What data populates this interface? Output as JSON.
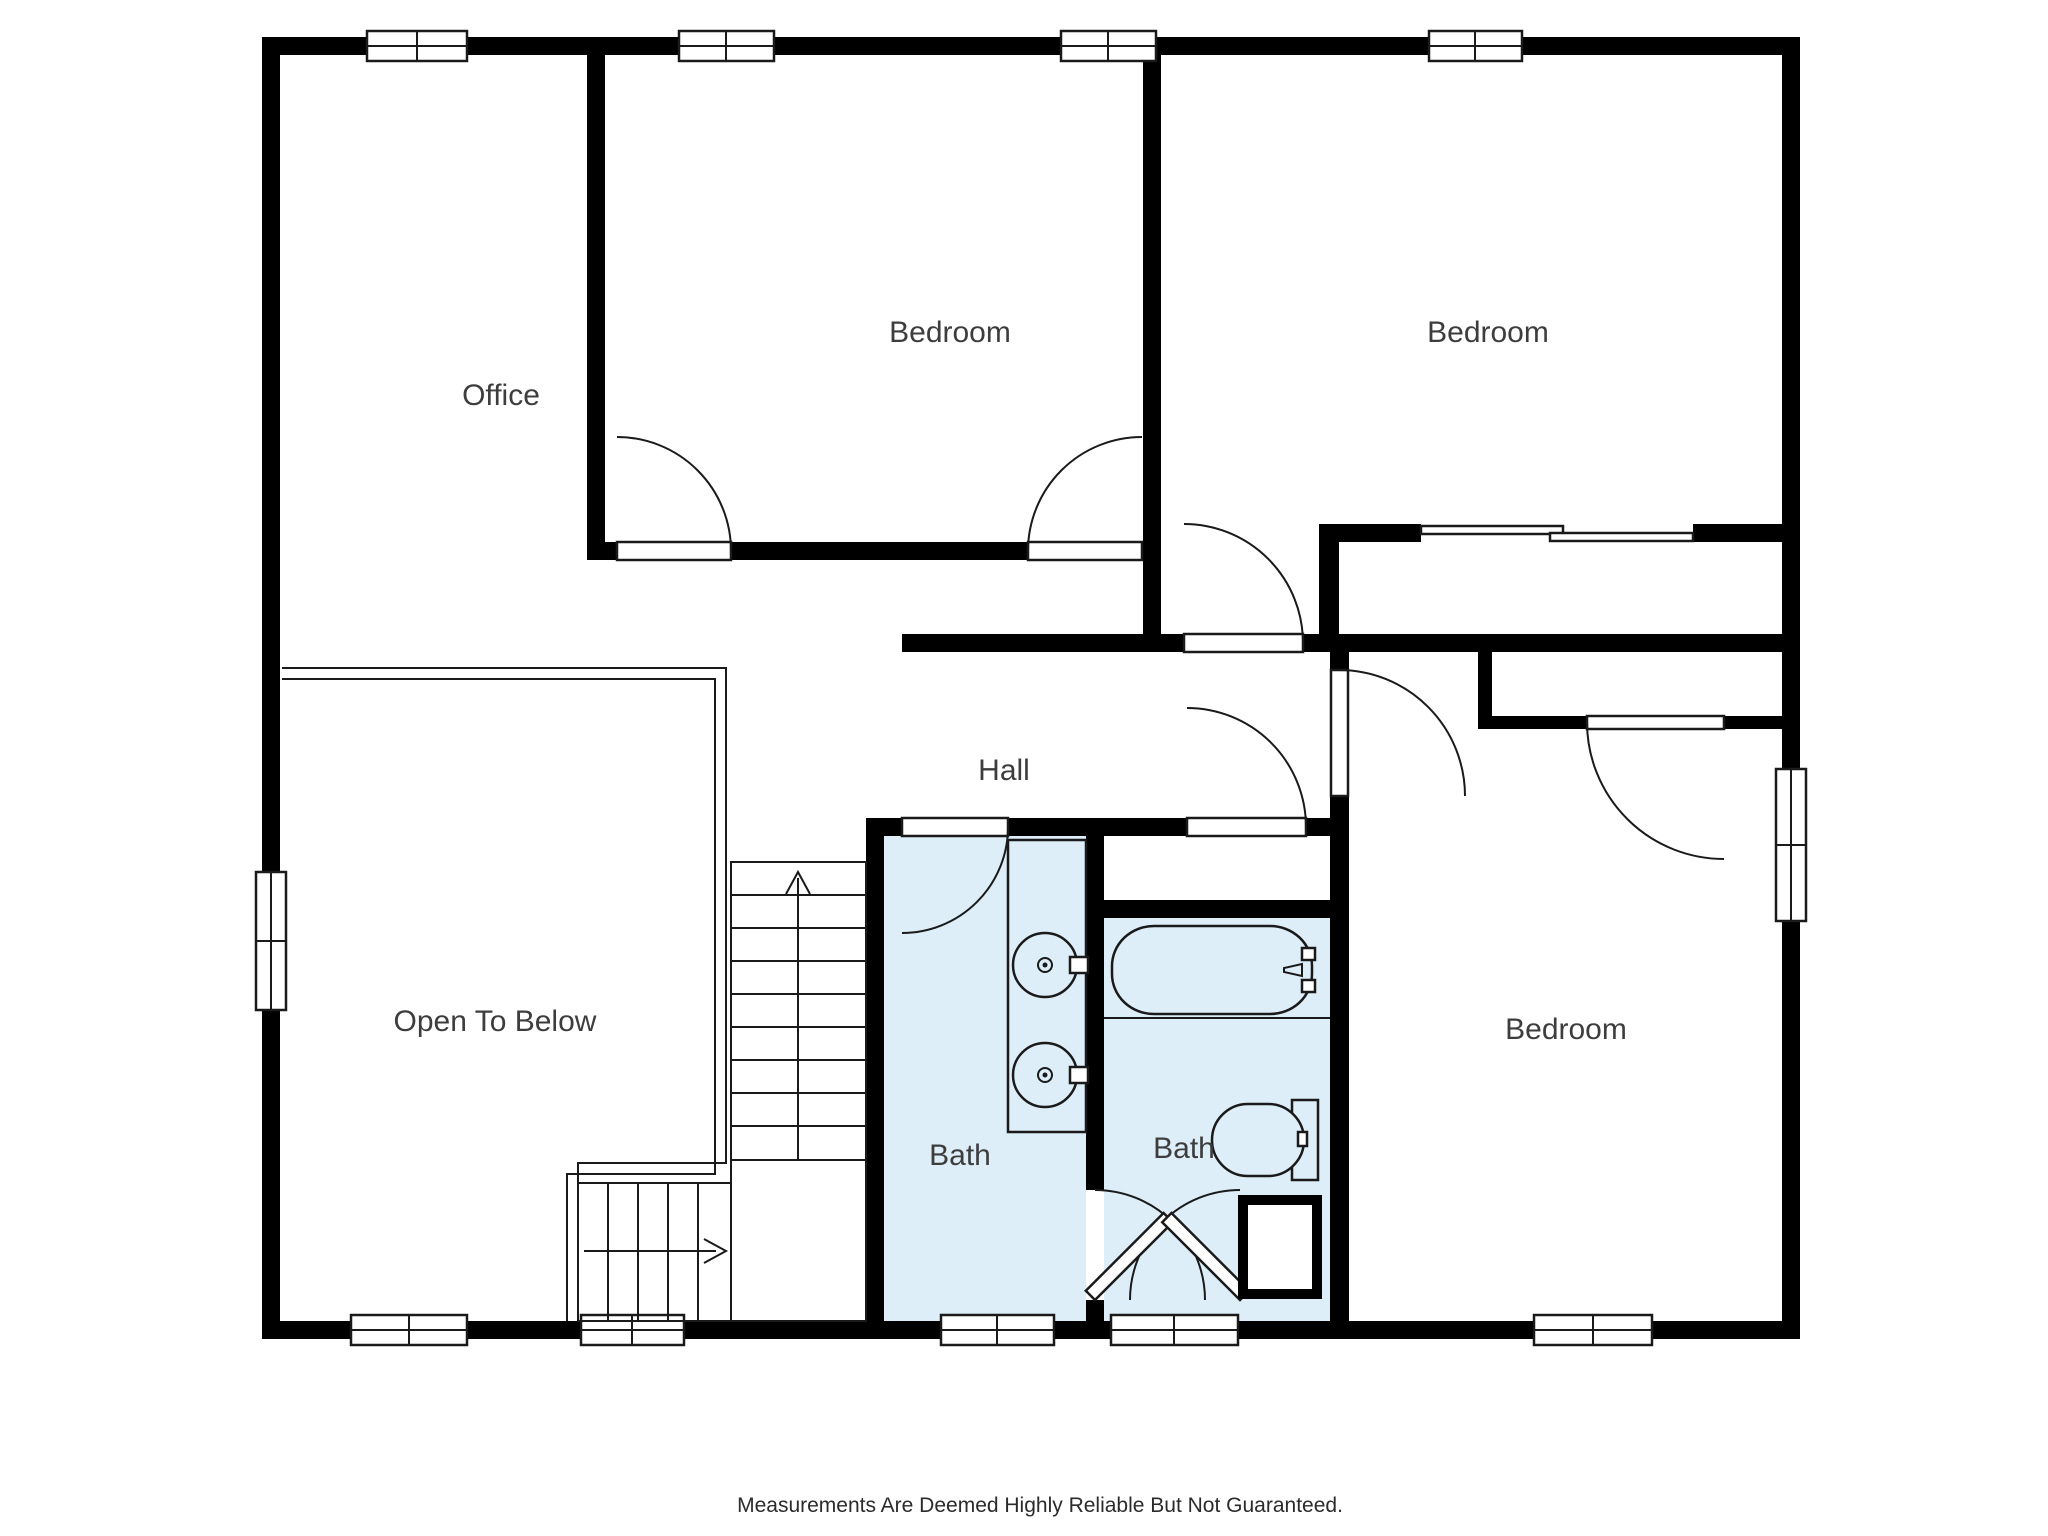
{
  "title": "Second Floor Plan",
  "disclaimer": "Measurements Are Deemed Highly Reliable But Not Guaranteed.",
  "colors": {
    "background": "#ffffff",
    "walls": "#000000",
    "bath_highlight": "#ddeef9",
    "label_text": "#3d3d3d"
  },
  "rooms": [
    {
      "id": "office",
      "label": "Office"
    },
    {
      "id": "bedroom-top-middle",
      "label": "Bedroom"
    },
    {
      "id": "bedroom-top-right",
      "label": "Bedroom"
    },
    {
      "id": "hall",
      "label": "Hall"
    },
    {
      "id": "open-to-below",
      "label": "Open To Below"
    },
    {
      "id": "bath-left",
      "label": "Bath"
    },
    {
      "id": "bath-right",
      "label": "Bath"
    },
    {
      "id": "bedroom-bottom-right",
      "label": "Bedroom"
    }
  ],
  "fixtures": [
    "bathtub",
    "toilet",
    "double-vanity-sinks",
    "l-shaped-staircase",
    "stair-direction-arrows",
    "swing-doors",
    "sliding-closet-doors",
    "linen-closet"
  ],
  "windows": {
    "top_wall": 4,
    "bottom_wall": 5,
    "left_wall": 1,
    "right_wall": 1
  }
}
